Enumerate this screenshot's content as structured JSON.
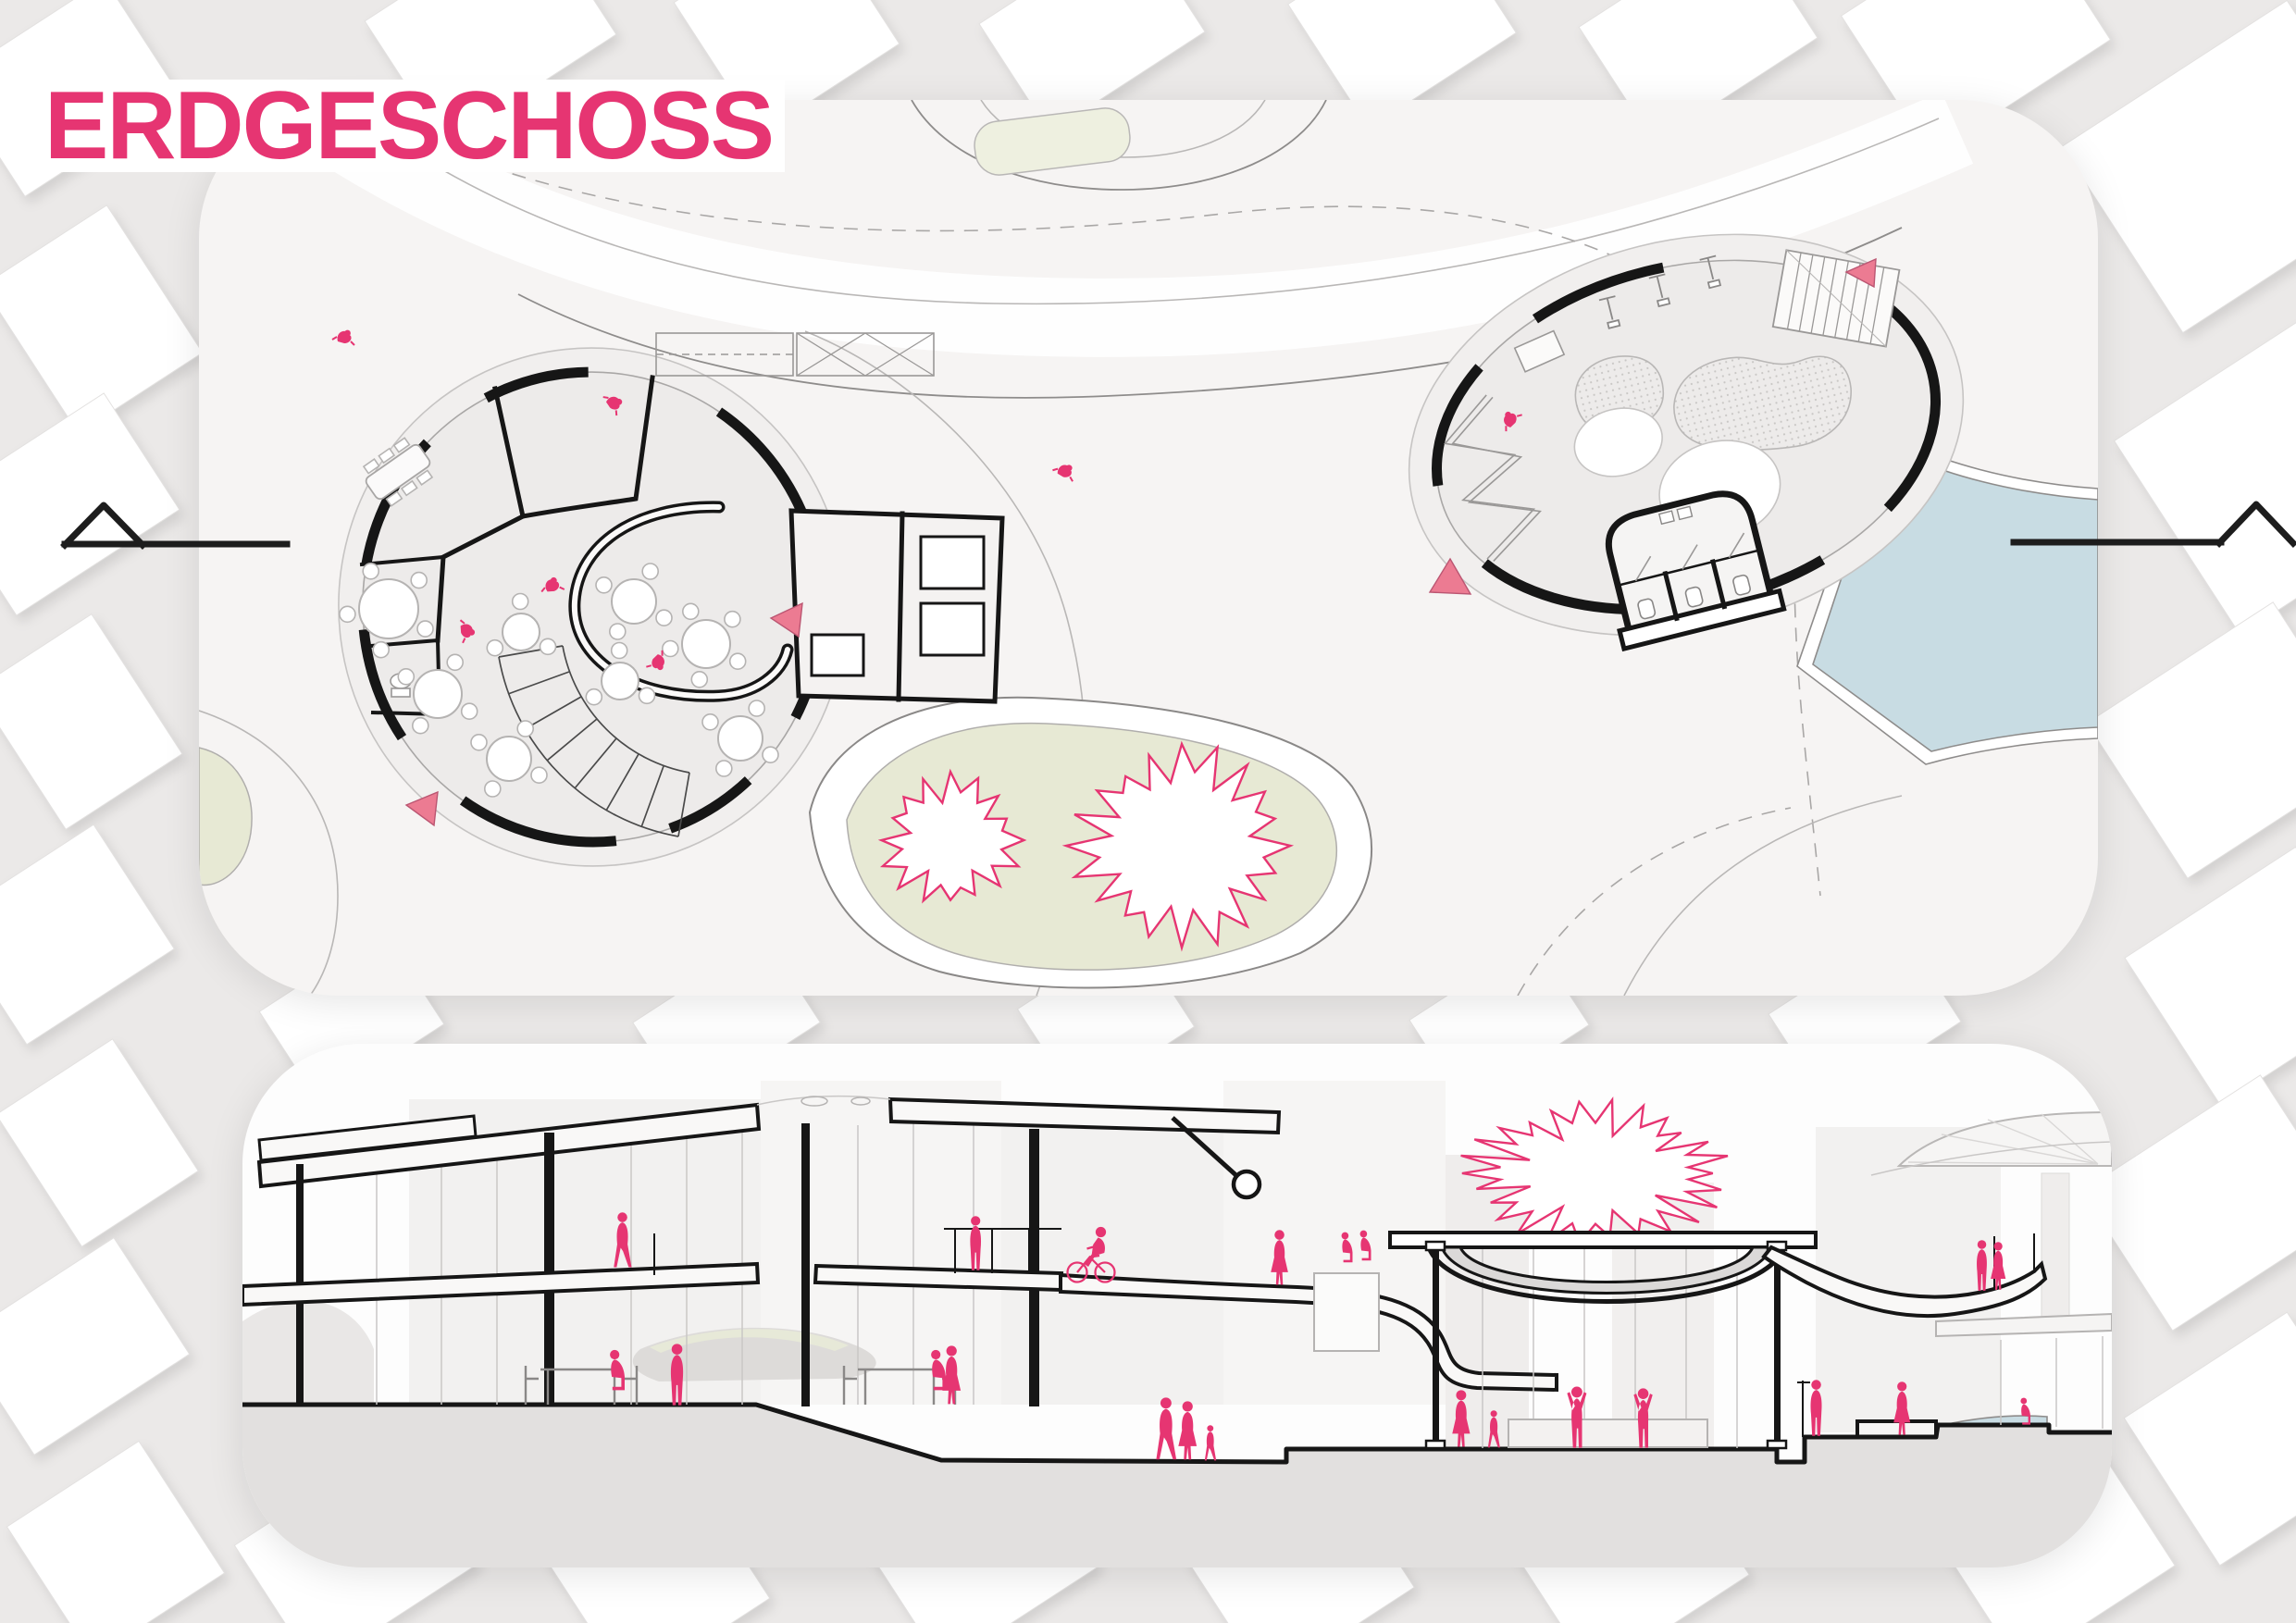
{
  "title": {
    "text": "ERDGESCHOSS"
  },
  "colors": {
    "accent-pink": "#e63572",
    "figure-pink": "#e63572",
    "marker-pink": "#ec7b92",
    "water-blue": "#c8dce3",
    "grass-green": "#e7e9d4",
    "paper": "#f6f4f3",
    "panel-white": "#fdfdfd",
    "bg-gray": "#ebe9e8",
    "ink": "#161616",
    "line-gray": "#b9b7b6"
  },
  "plan": {
    "label": "ground-floor-site-plan",
    "left_building": {
      "label": "cafe-building-plan",
      "round_tables": 8,
      "meeting_tables": 1,
      "entrance_markers": 2,
      "has_stairs": true,
      "has_counter": true,
      "has_wc": true
    },
    "right_building": {
      "label": "playground-pavilion-plan",
      "swings": 3,
      "entrance_markers": 2,
      "has_climbing_frame": true,
      "sandpits": 2,
      "has_wc": true
    },
    "landscape": {
      "trees": 2,
      "pond": true,
      "lawn_island": true
    },
    "plan_figures": 7
  },
  "section": {
    "label": "longitudinal-section",
    "buildings": [
      "two-storey-cafe",
      "event-pavilion",
      "neighbor-building"
    ],
    "has_cycle_ramp": true,
    "has_roof_tree": true,
    "section_figures": 22
  },
  "section_markers": {
    "left": true,
    "right": true
  }
}
